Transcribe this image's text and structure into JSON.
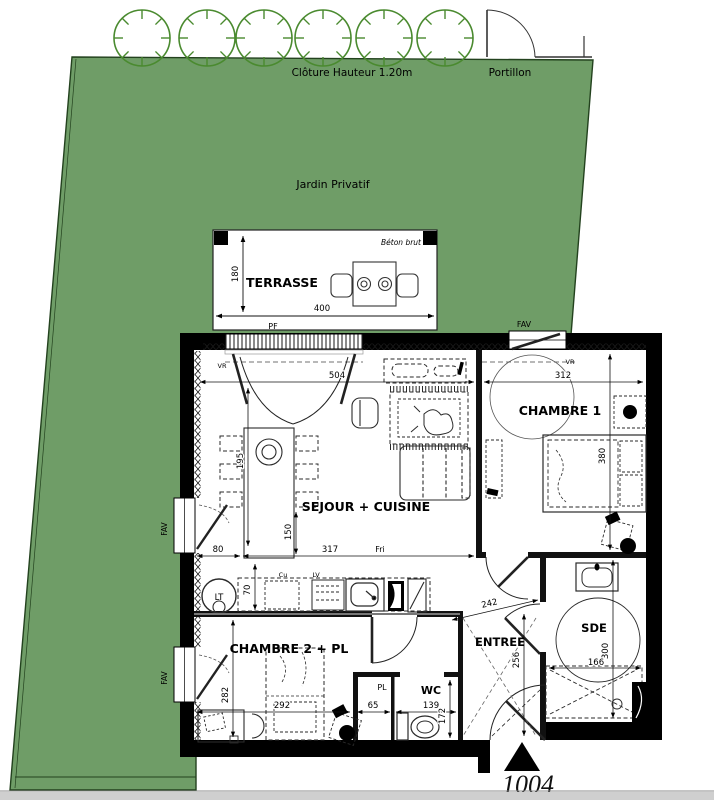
{
  "plan": {
    "lot_number": "1004",
    "site": {
      "fence_label": "Clôture Hauteur 1.20m",
      "gate_label": "Portillon",
      "garden_label": "Jardin Privatif"
    },
    "terrace": {
      "label": "TERRASSE",
      "note": "Béton brut",
      "width_cm": "400",
      "depth_cm": "180",
      "bay_label": "PF"
    },
    "windows": {
      "fav": "FAV",
      "vr": "VR"
    },
    "rooms": {
      "living": {
        "label": "SEJOUR + CUISINE"
      },
      "bedroom1": {
        "label": "CHAMBRE 1"
      },
      "bedroom2": {
        "label": "CHAMBRE 2 + PL"
      },
      "entry": {
        "label": "ENTREE"
      },
      "shower": {
        "label": "SDE"
      },
      "wc": {
        "label": "WC"
      },
      "closet": {
        "label": "PL"
      }
    },
    "kitchen": {
      "fridge": "Fri",
      "dishwasher": "LV",
      "cooktop": "Cu",
      "washer": "LT"
    },
    "dims": {
      "d504": "504",
      "d312": "312",
      "d195": "195",
      "d150": "150",
      "d80": "80",
      "d317": "317",
      "d70": "70",
      "d380": "380",
      "d242": "242",
      "d256": "256",
      "d300": "300",
      "d166": "166",
      "d282": "282",
      "d292": "292",
      "d65": "65",
      "d139": "139",
      "d172": "172"
    },
    "colors": {
      "garden_green": "#6f9d67",
      "tree_green": "#4a8a2f",
      "wall_black": "#000000"
    }
  }
}
